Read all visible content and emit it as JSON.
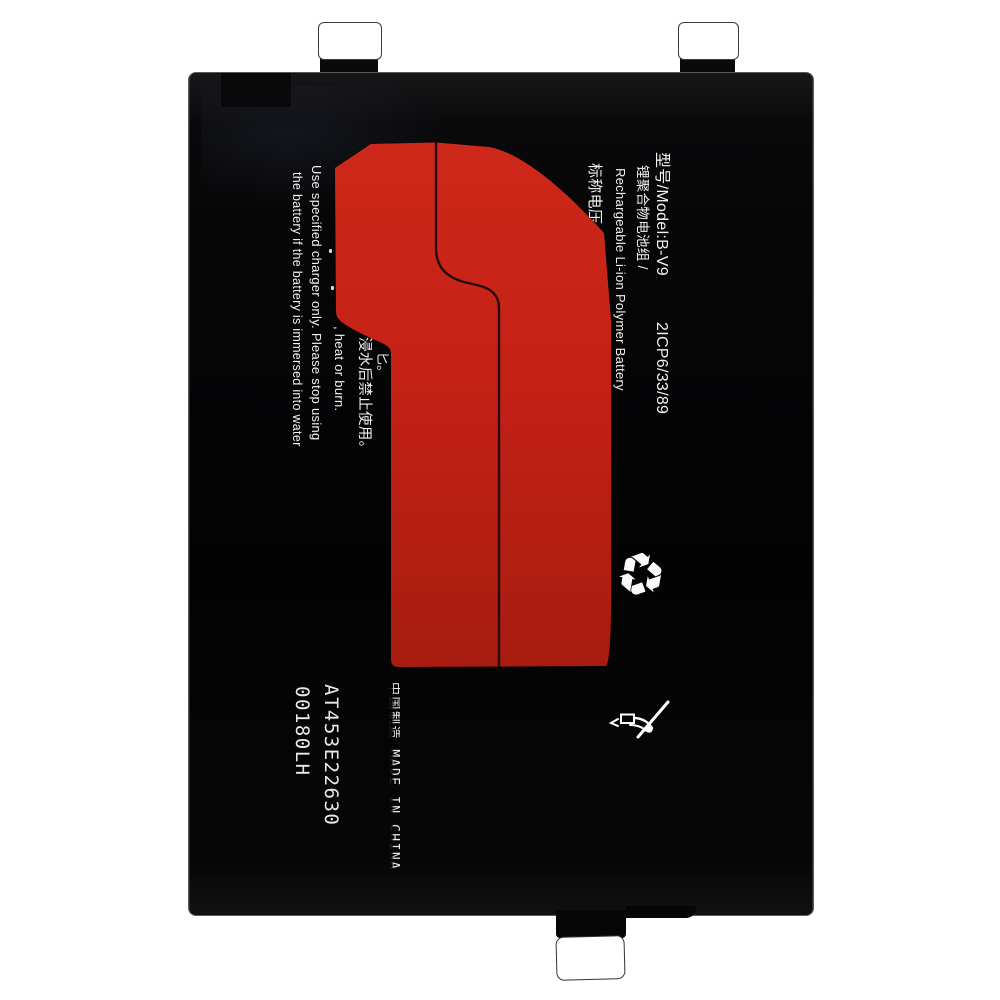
{
  "label": {
    "model_line": "型号/Model:B-V9",
    "cell_spec": "2ICP6/33/89",
    "type_cn": "锂聚合物电池组 /",
    "type_en": "Rechargeable Li-ion Polymer Battery",
    "voltage_label": "标称电压",
    "warning_line1": "Use specified charger only. Please stop using",
    "warning_line2": "the battery if the battery is immersed into water",
    "warning_fragment_en": ", heat or burn.",
    "warning_fragment_cn": "浸水后禁止使用。",
    "fragment_top": "匕。",
    "fragment_mid": "匕。",
    "batch_code": "AT453E22630",
    "batch_code2": "00180LH",
    "made_in": "中国制造 MADE IN CHINA"
  },
  "icons": {
    "recycle_symbol": "♻",
    "recycle_name": "recycling-symbol",
    "caution_name": "do-not-pry-tool-crossed-out"
  },
  "colors": {
    "background": "#ffffff",
    "body_black": "#060607",
    "sticker_red": "#c42116",
    "sticker_red_light": "#cd2819",
    "sticker_red_dark": "#a81c10",
    "crease_line": "#260b07",
    "text_white": "#f2f2f2"
  }
}
